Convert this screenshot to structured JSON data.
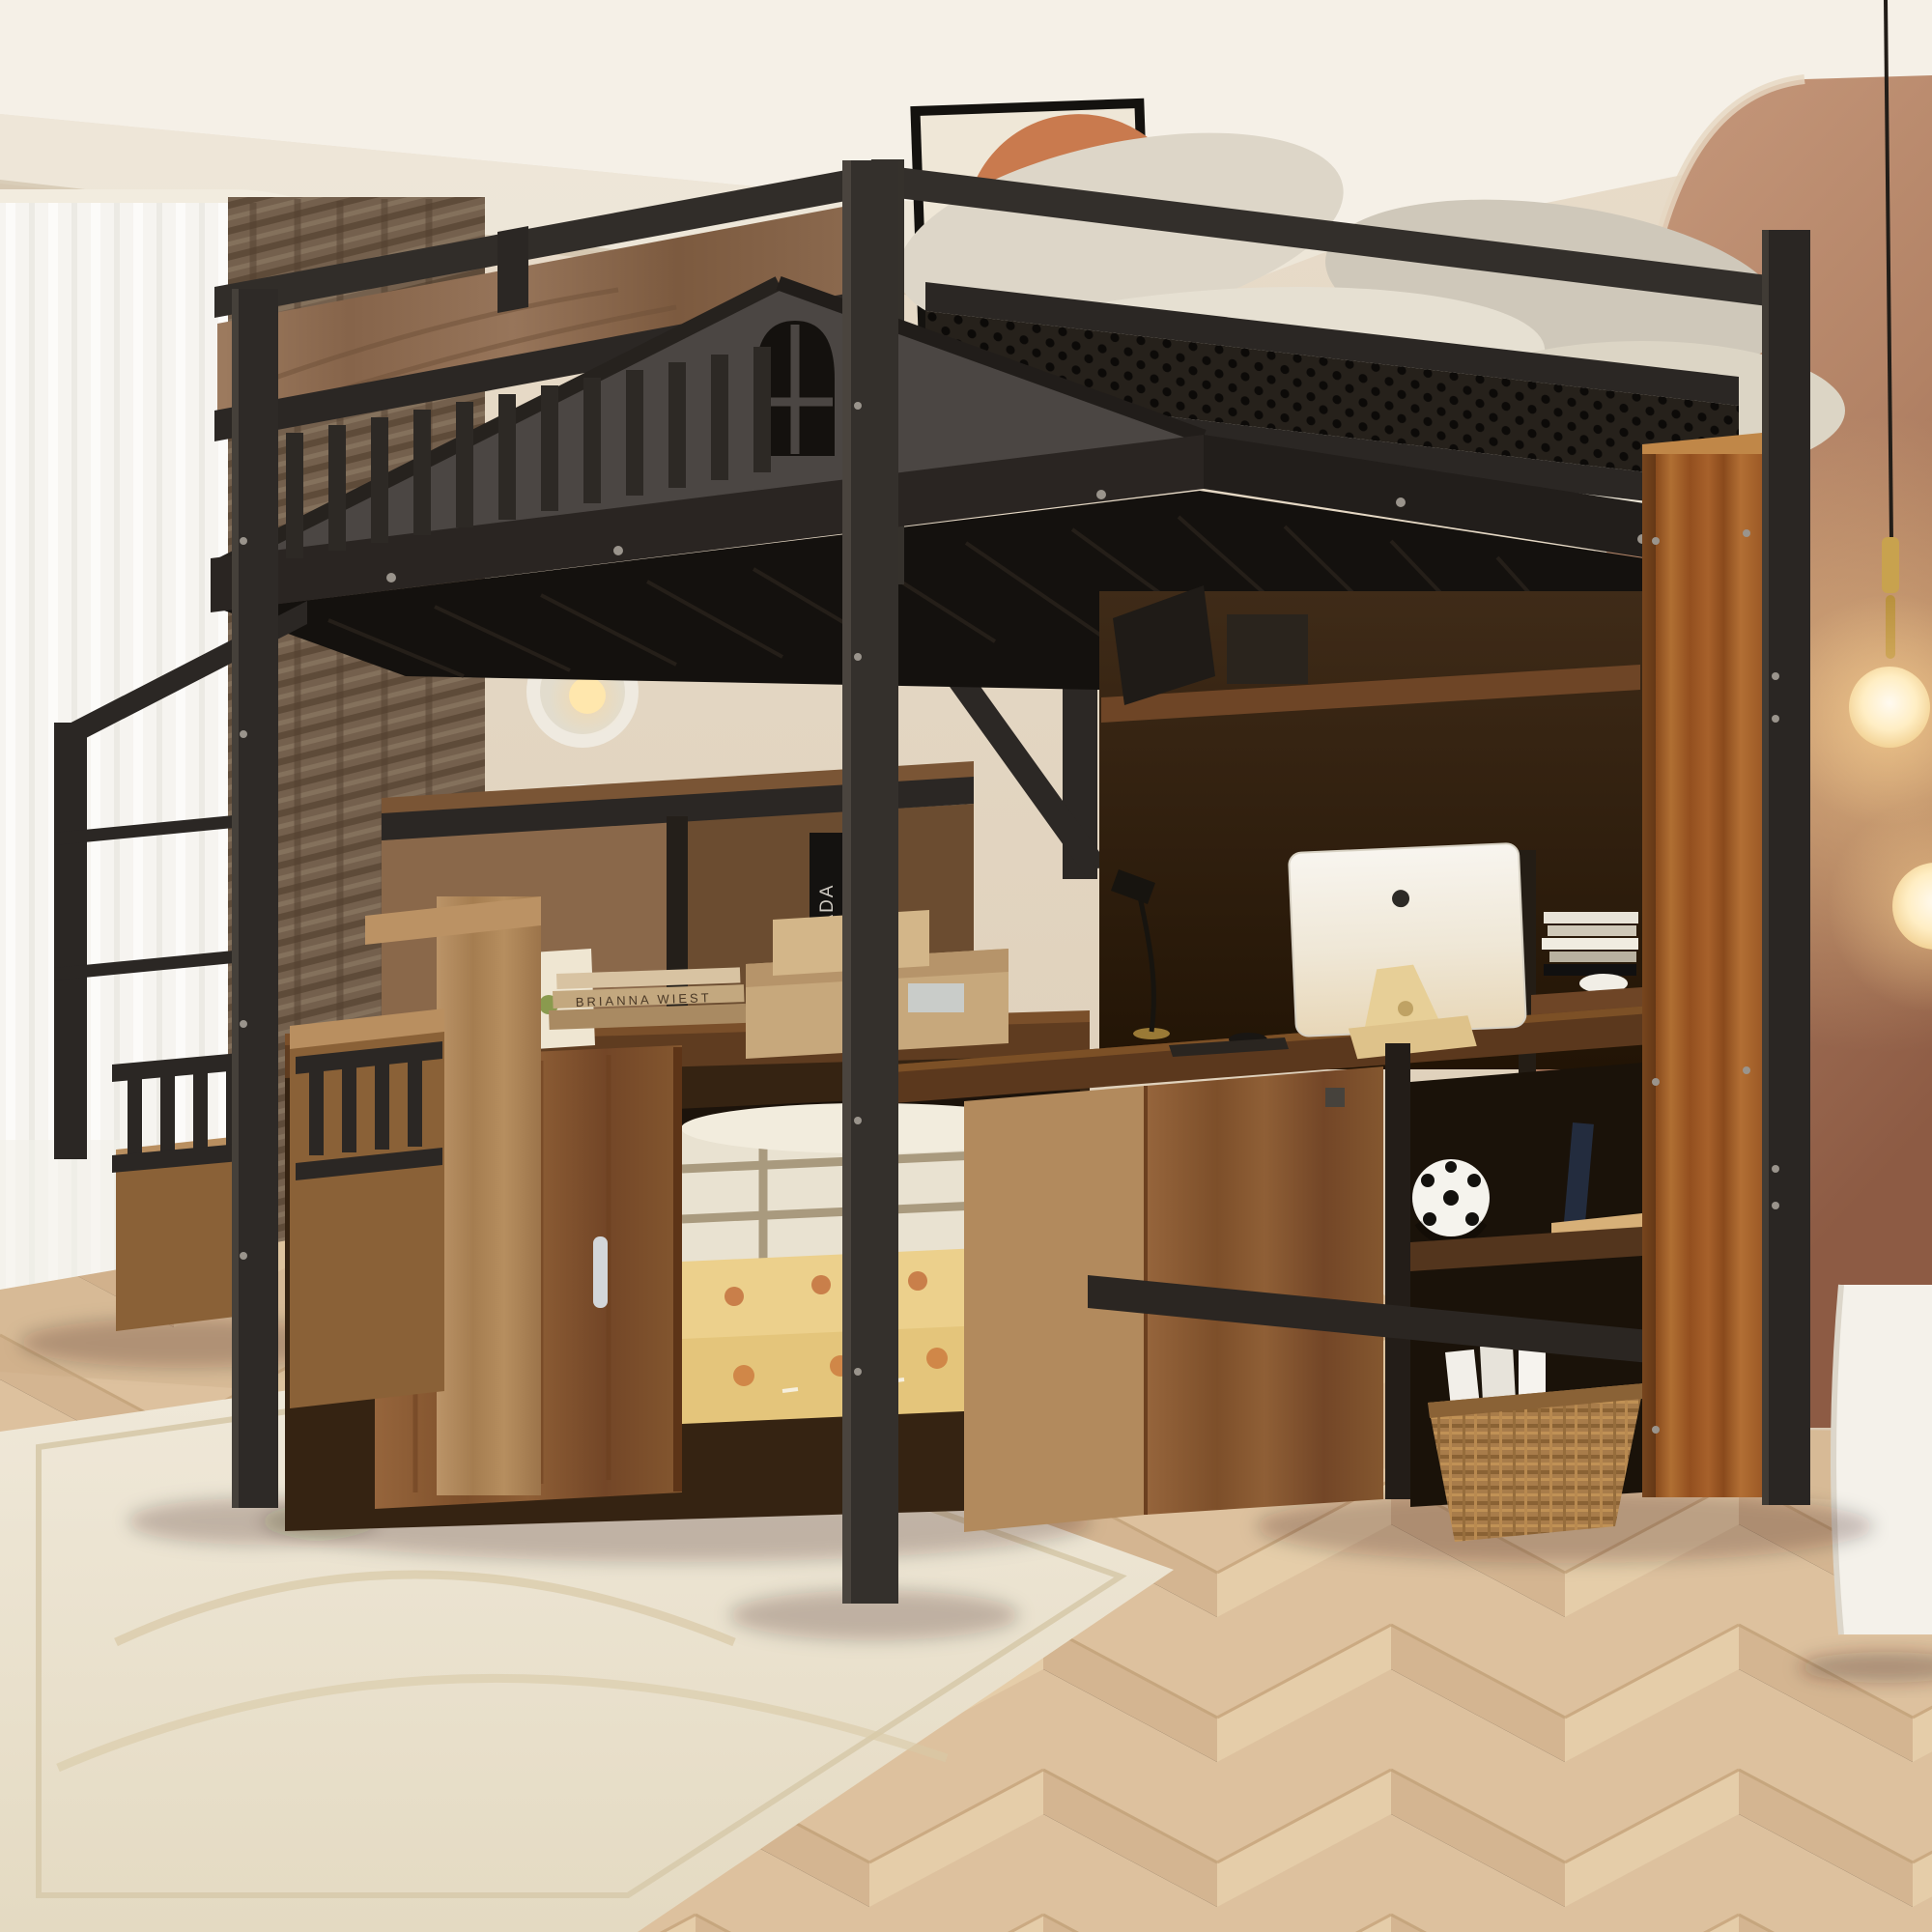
{
  "image": {
    "kind": "furniture product photograph (3D render)",
    "subject": "Black metal full-size loft bed with house-shaped gable and arched window cutout, wood accent panels, perforated metal guard rail, storage staircase, wardrobe cabinet with open door showing folded comforters, built-in desk with computer, and bookshelf tower, staged in a beige bedroom with terracotta arch wall, sheer and brown curtains, pendant globe lamps and chevron wood floor"
  },
  "texts": {
    "book_stack_spine": "BRIANNA WIEST",
    "black_book_spine": "PRADA"
  },
  "palette": {
    "metal": "#2e2a26",
    "metal-hi": "#3b3631",
    "metal-dk": "#1c1916",
    "wall": "#e6dac7",
    "wall-dk": "#d3c2ab",
    "ceil": "#f5f0e7",
    "terra": "#bc8e72",
    "terra-dk": "#8d5b44",
    "floor": "#ddc19e",
    "floor-dk": "#d2b38c",
    "rug": "#ece3d1",
    "sheer": "#f6f4f0",
    "drape": "#74604d",
    "bedding": "#e4ddcd",
    "pillow": "#d0c9ba",
    "gold": "#c8a24e",
    "globe": "#ffeec4",
    "screen": "#f3efe6",
    "plaid": "#e9e2d1",
    "shiba": "#e9cd87",
    "basket": "#a87c4a"
  },
  "objects": [
    "loft-bed-frame",
    "guard-railing-slats",
    "perforated-guard-panel",
    "house-gable-with-arched-window",
    "wood-accent-headboard-panel",
    "metal-deck-soffit",
    "diagonal-braces",
    "storage-staircase",
    "stair-guard-fences",
    "wardrobe-cabinet-open-door",
    "chrome-door-handle",
    "plaid-comforter",
    "shiba-print-comforters",
    "mid-bookshelf",
    "black-prada-books",
    "book-stack",
    "kraft-storage-boxes",
    "art-calendar-card",
    "desk",
    "imac-computer",
    "desk-lamp",
    "computer-mouse",
    "keyboard",
    "shelf-tower",
    "laptop",
    "white-bowl",
    "soccer-ball",
    "navy-book",
    "tan-book",
    "wicker-basket",
    "magazines",
    "round-wall-sconces",
    "pendant-globe-lamps",
    "framed-abstract-art",
    "sheer-curtain",
    "brown-drape",
    "terracotta-arch-wall",
    "white-floating-cabinet",
    "cream-rug",
    "chevron-wood-floor",
    "pillows-and-bedding",
    "mattress"
  ]
}
